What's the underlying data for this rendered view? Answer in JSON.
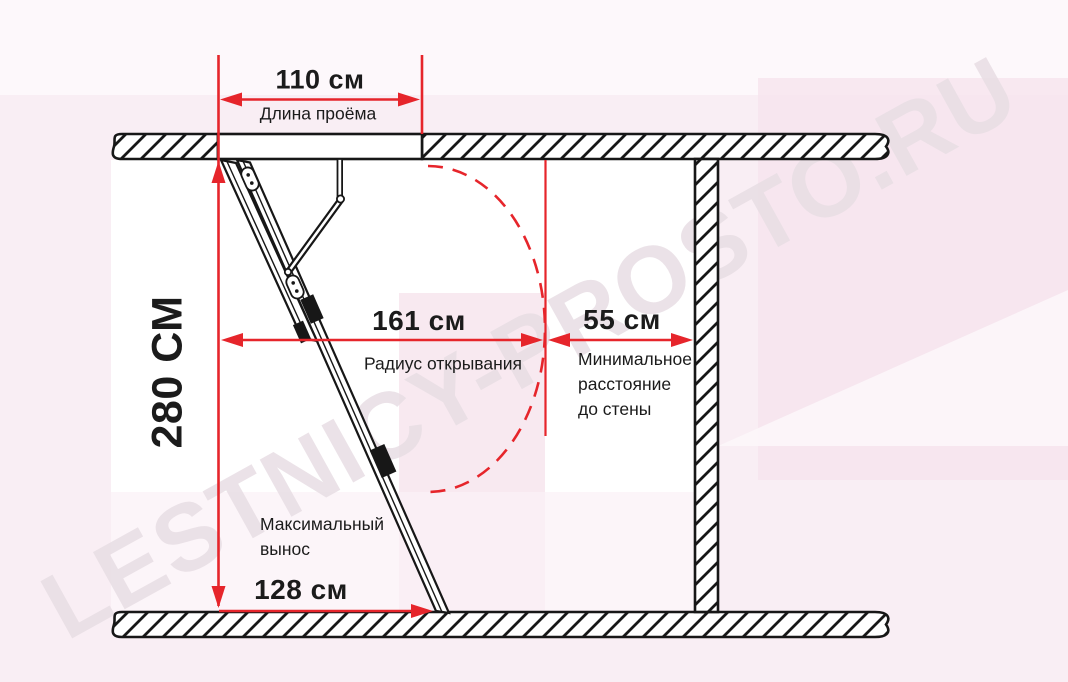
{
  "watermark": "LESTNICY-PROSTO.RU",
  "colors": {
    "dimension_red": "#e6252b",
    "drawing_black": "#171717",
    "watermark_tint": "#e8dee4",
    "background_pink": "#f9eef4"
  },
  "dimensions": {
    "opening_length": {
      "value": "110 см",
      "label": "Длина проёма"
    },
    "ceiling_height": {
      "value": "280 СМ"
    },
    "opening_radius": {
      "value": "161 см",
      "label": "Радиус открывания"
    },
    "wall_distance": {
      "value": "55 см",
      "label_lines": [
        "Минимальное",
        "расстояние",
        "до стены"
      ]
    },
    "max_extension": {
      "value": "128 см",
      "label_lines": [
        "Максимальный",
        "вынос"
      ]
    }
  }
}
